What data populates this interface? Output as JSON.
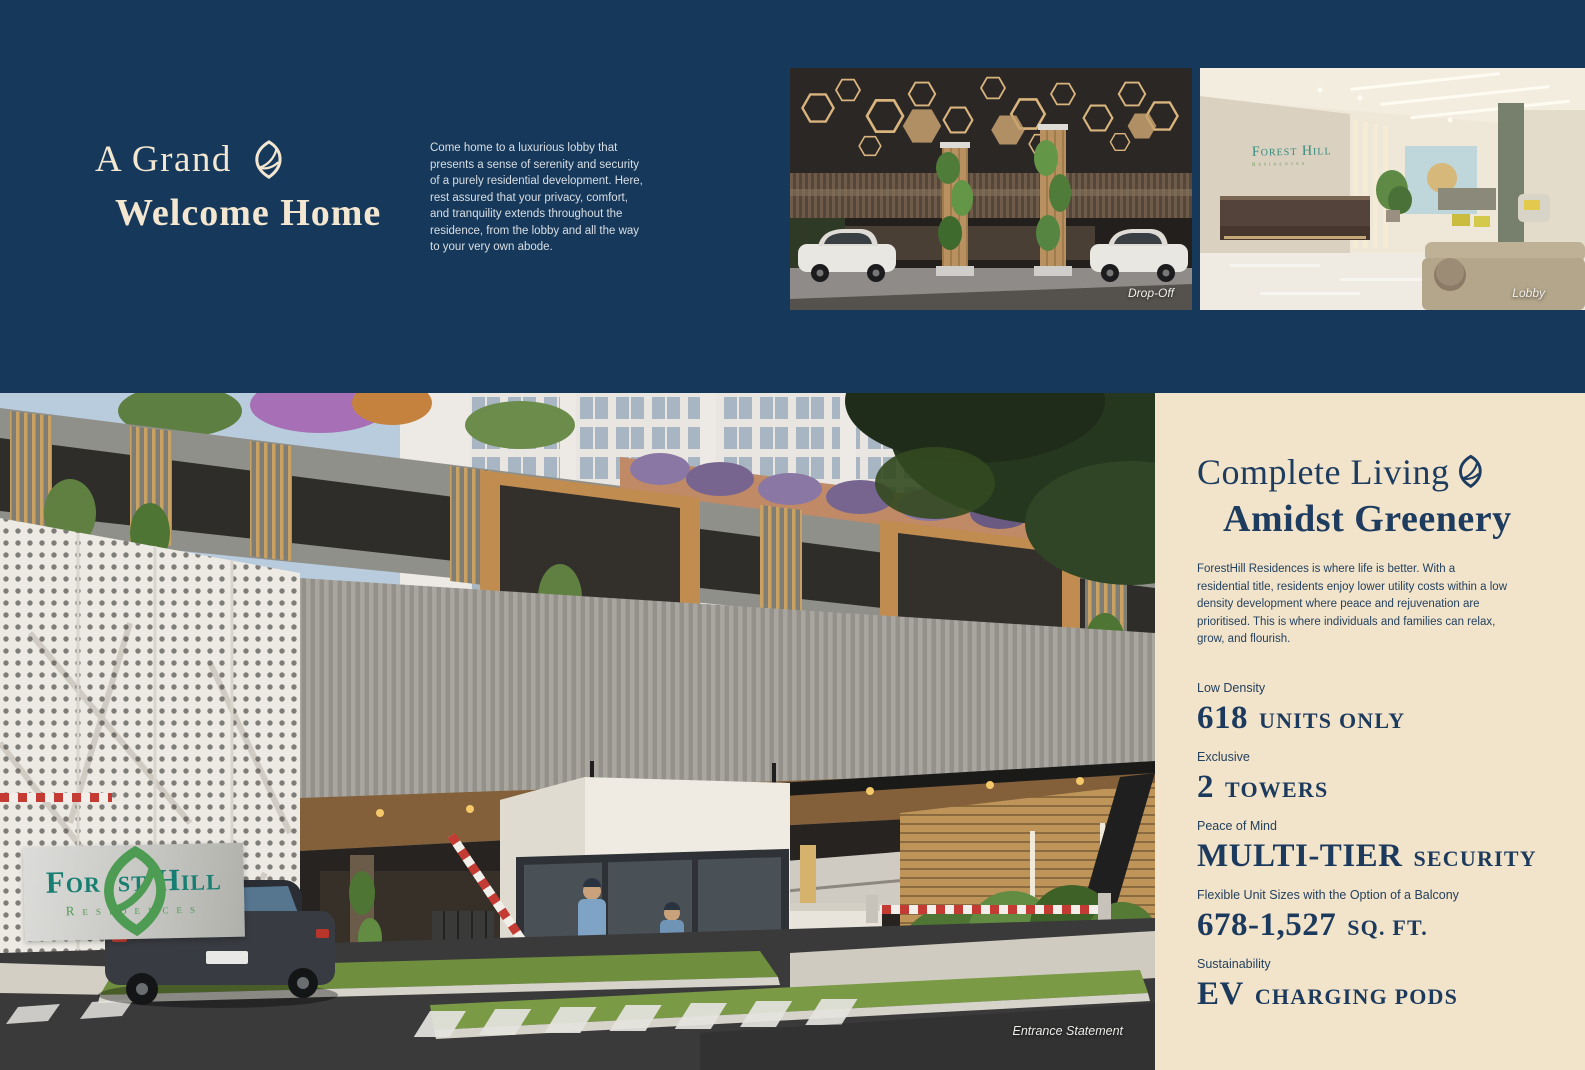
{
  "colors": {
    "navy_bg": "#16395B",
    "cream_panel": "#F2E4CA",
    "cream_text": "#F3E7D1",
    "navy_text": "#1D3C5F",
    "logo_teal": "#177E72",
    "logo_green": "#4E9B53"
  },
  "icons": {
    "leaf": "leaf-icon"
  },
  "hero": {
    "title_line1": "A Grand",
    "title_line2": "Welcome Home",
    "paragraph": "Come home to a luxurious lobby that presents a sense of serenity and security of a purely residential development. Here, rest assured that your privacy, comfort, and tranquility extends throughout the residence, from the lobby and all the way to your very own abode."
  },
  "photos": {
    "dropoff_caption": "Drop-Off",
    "lobby_caption": "Lobby",
    "entrance_caption": "Entrance Statement"
  },
  "signage": {
    "logo_a": "For",
    "logo_b": "st",
    "logo_c": "Hill",
    "logo_sub": "Residences",
    "lobby_line1": "Forest Hill",
    "lobby_line2": "Residences"
  },
  "panel": {
    "title_line1": "Complete Living",
    "title_line2": "Amidst Greenery",
    "paragraph": "ForestHill Residences is where life is better. With a residential title, residents enjoy lower utility costs within a low density development where peace and rejuvenation are prioritised. This is where individuals and families can relax, grow, and flourish.",
    "features": [
      {
        "label": "Low Density",
        "value_lead": "618",
        "value_rest": "UNITS ONLY"
      },
      {
        "label": "Exclusive",
        "value_lead": "2",
        "value_rest": "TOWERS"
      },
      {
        "label": "Peace of Mind",
        "value_lead": "MULTI-TIER",
        "value_rest": "SECURITY"
      },
      {
        "label": "Flexible Unit Sizes with the Option of a Balcony",
        "value_lead": "678-1,527",
        "value_rest": "SQ. FT."
      },
      {
        "label": "Sustainability",
        "value_lead": "EV",
        "value_rest": "CHARGING PODS"
      }
    ]
  }
}
